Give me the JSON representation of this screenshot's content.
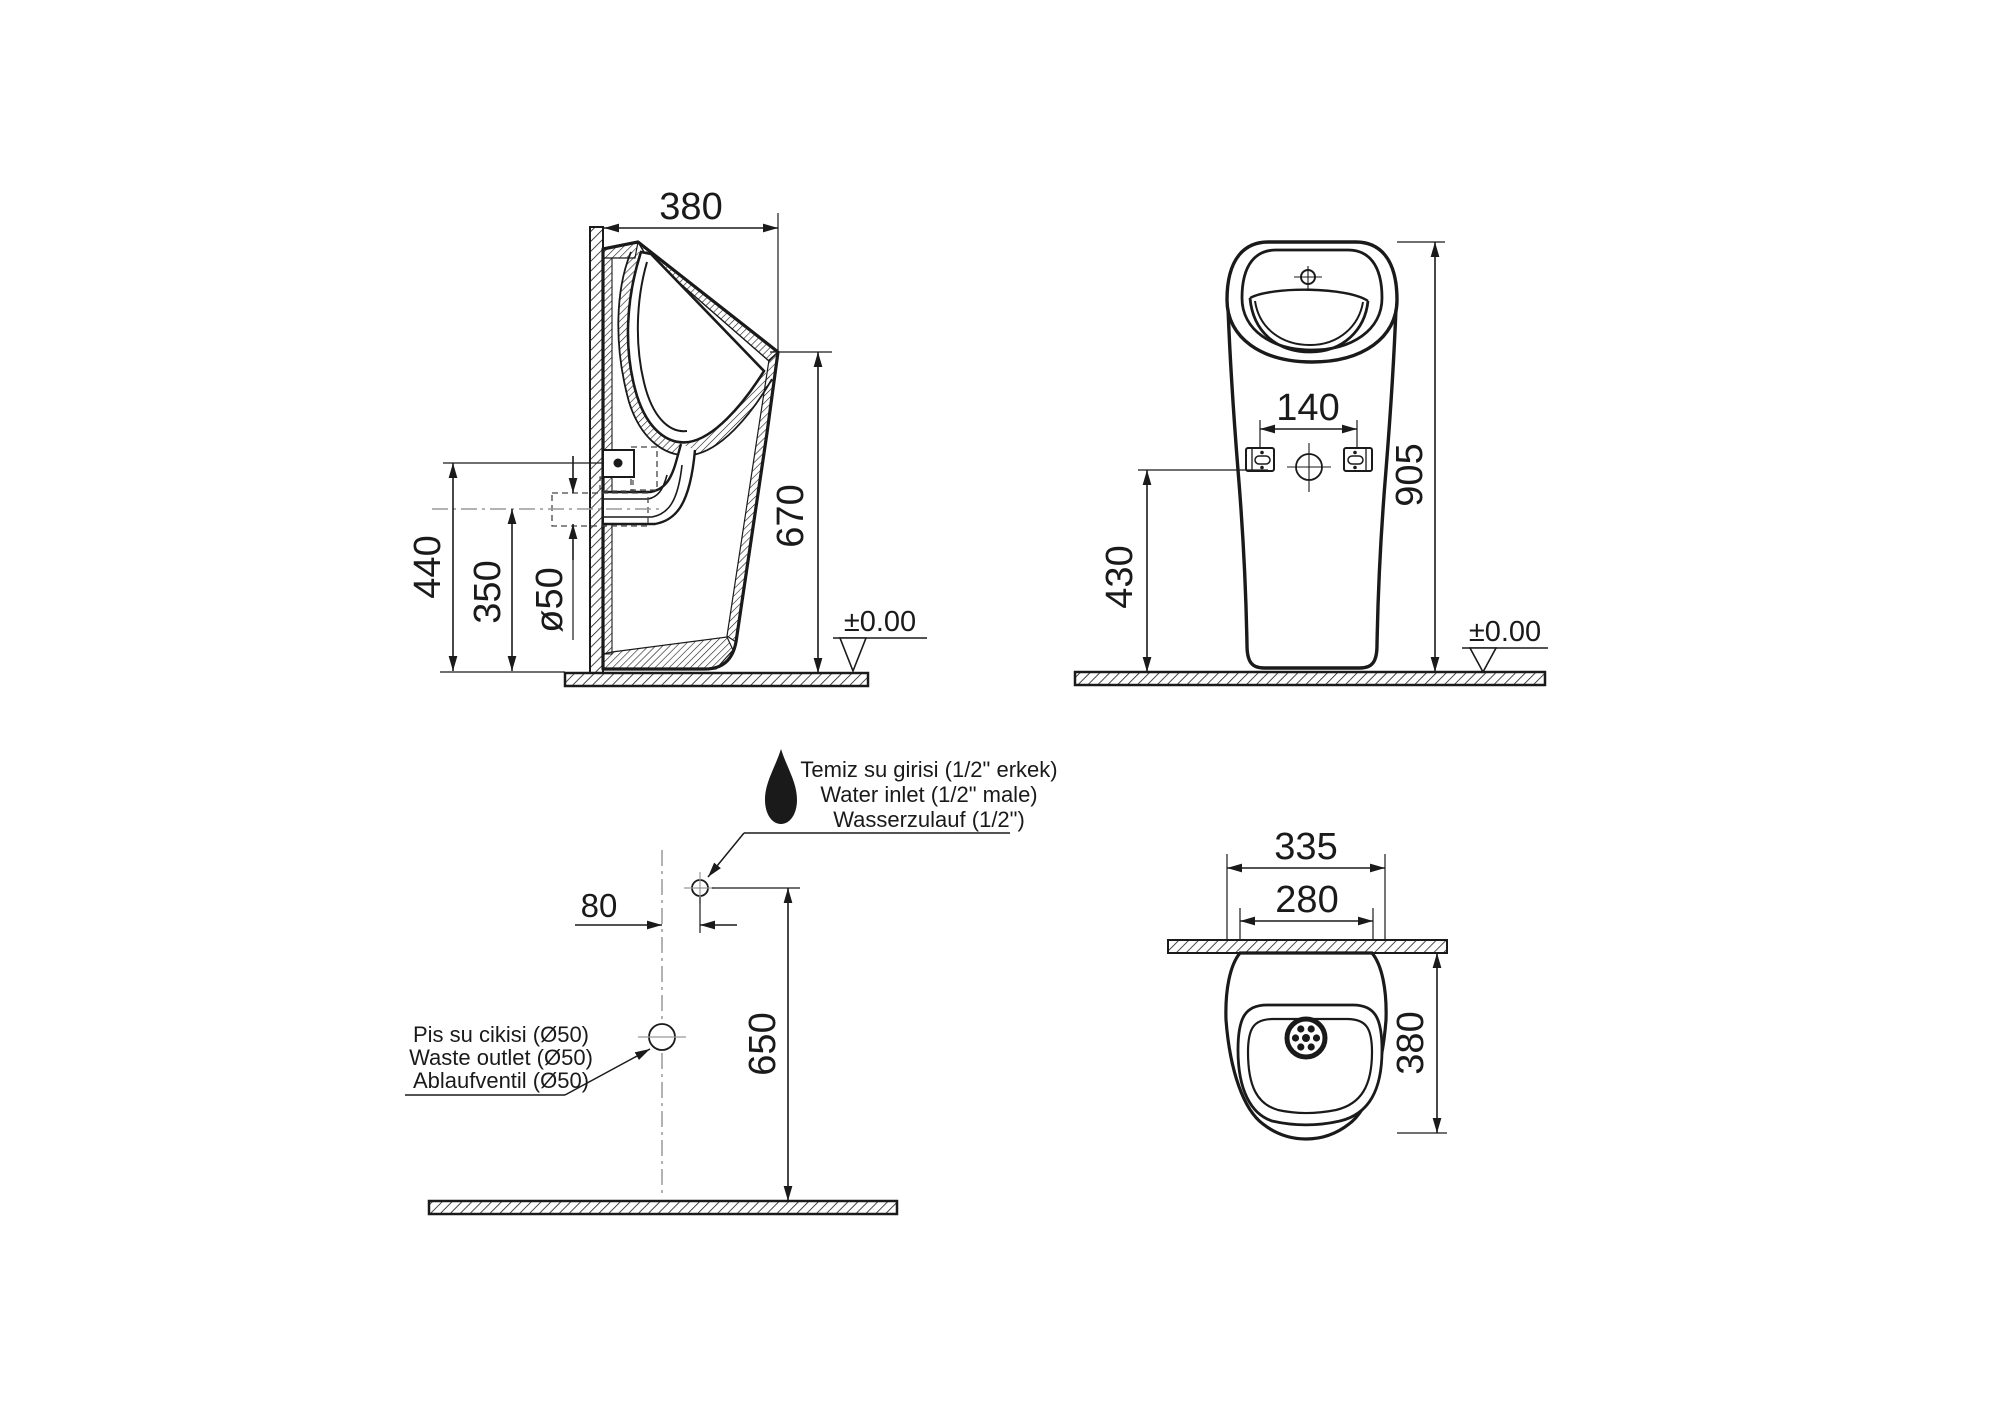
{
  "document": {
    "type": "technical-installation-drawing",
    "product": "floor-standing urinal",
    "background": "#ffffff",
    "line_color": "#1a1a1a",
    "centerline_color": "#999999"
  },
  "side_view": {
    "width": "380",
    "front_height": "670",
    "fixing_height": "440",
    "outlet_height": "350",
    "outlet_diameter": "ø50",
    "floor_level": "±0.00"
  },
  "front_view": {
    "fixing_hole_spacing": "140",
    "overall_height": "905",
    "fixing_height": "430",
    "floor_level": "±0.00"
  },
  "installation_view": {
    "inlet_offset": "80",
    "inlet_height": "650",
    "water_inlet_labels": [
      "Temiz su girisi (1/2\" erkek)",
      "Water inlet (1/2\" male)",
      "Wasserzulauf (1/2\")"
    ],
    "waste_outlet_labels": [
      "Pis su cikisi (Ø50)",
      "Waste outlet (Ø50)",
      "Ablaufventil (Ø50)"
    ]
  },
  "top_view": {
    "overall_width": "335",
    "inner_width": "280",
    "depth": "380"
  }
}
